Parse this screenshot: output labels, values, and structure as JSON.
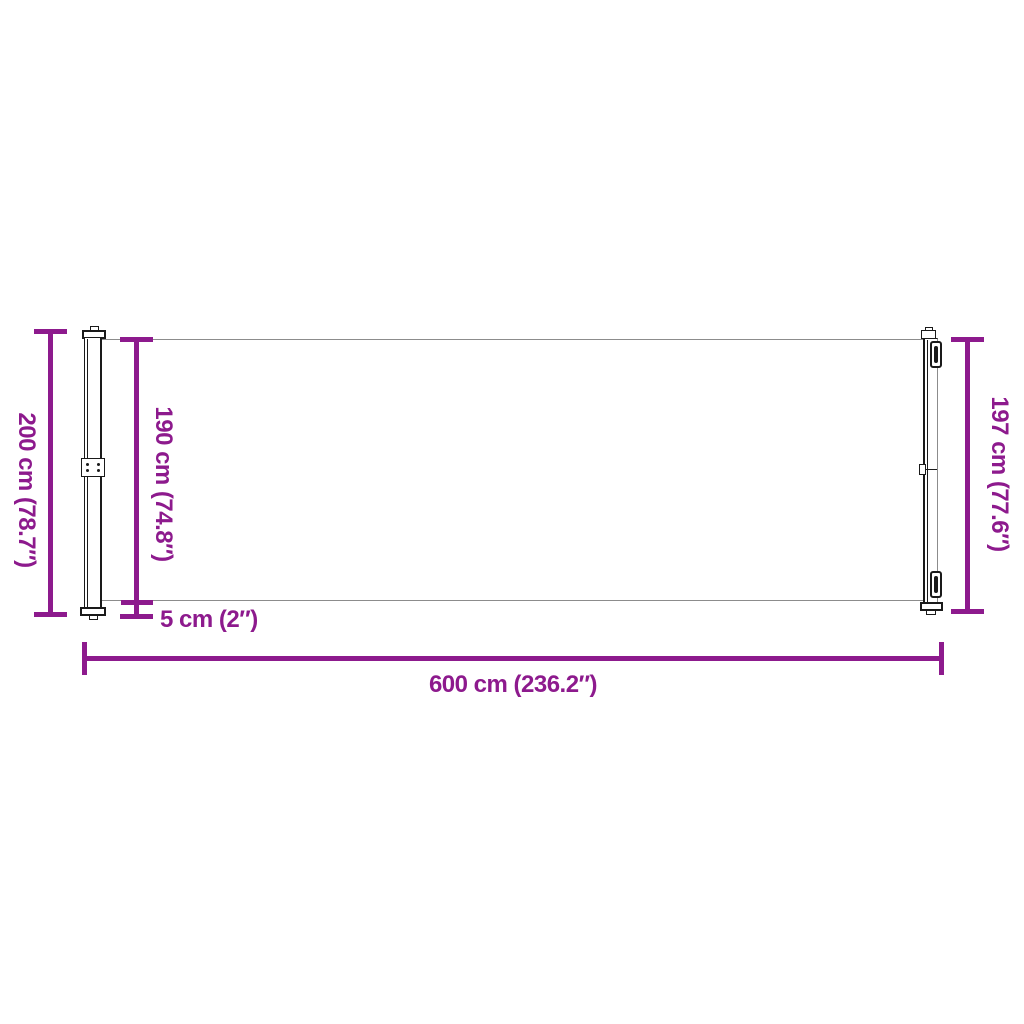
{
  "diagram": {
    "accent_color": "#8D1A8D",
    "labels": {
      "total_height": "200 cm (78.7″)",
      "fabric_height": "190 cm (74.8″)",
      "front_pole_height": "197 cm (77.6″)",
      "ground_clearance": "5 cm (2″)",
      "total_length": "600 cm (236.2″)"
    }
  }
}
